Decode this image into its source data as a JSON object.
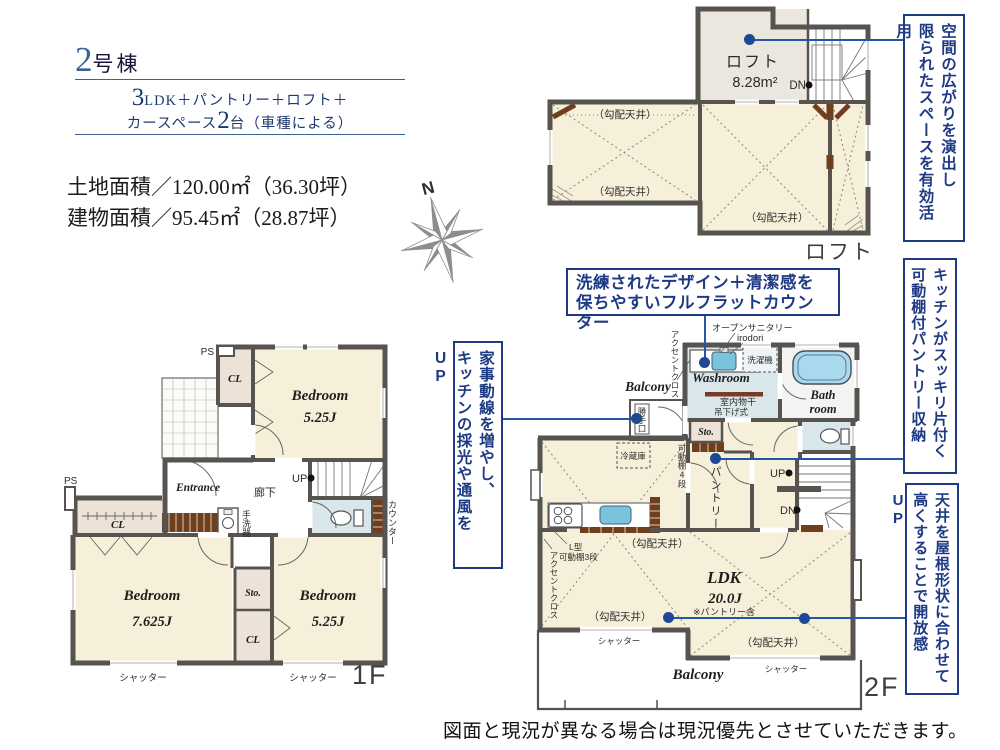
{
  "header": {
    "unit_num": "2",
    "unit_suffix": "号棟",
    "sub1_num": "3",
    "sub1_text": "LDK＋パントリー＋ロフト＋",
    "sub2_pre": "カースペース",
    "sub2_num": "2",
    "sub2_post": "台（車種による）"
  },
  "areas": {
    "land": "土地面積／120.00㎡（36.30坪）",
    "building": "建物面積／95.45㎡（28.87坪）"
  },
  "compass": {
    "north": "N"
  },
  "annotations": {
    "loft_space": {
      "line1": "空間の広がりを演出し",
      "line2": "限られたスペースを有効活用"
    },
    "pantry": {
      "line1": "キッチンがスッキリ片付く",
      "line2": "可動棚付パントリー収納"
    },
    "ceiling": {
      "line1": "天井を屋根形状に合わせて",
      "line2": "高くすることで開放感UP"
    },
    "housework": {
      "line1": "家事動線を増やし、",
      "line2": "キッチンの採光や通風をUP"
    },
    "counter": {
      "line1": "洗練されたデザイン＋清潔感を",
      "line2": "保ちやすいフルフラットカウンター"
    }
  },
  "loft": {
    "room": "ロフト",
    "area": "8.28m²",
    "dn": "DN",
    "sloped": "（勾配天井）",
    "floor_label": "ロフト"
  },
  "f1": {
    "ps": "PS",
    "cl": "CL",
    "bedroom": "Bedroom",
    "b1_size": "5.25J",
    "b2_size": "7.625J",
    "b3_size": "5.25J",
    "entrance": "Entrance",
    "corridor": "廊下",
    "up": "UP",
    "basin": "手洗器",
    "counter": "カウンター",
    "sto": "Sto.",
    "shutter": "シャッター",
    "floor_label": "1F"
  },
  "f2": {
    "accent": "アクセントクロス",
    "open_sanitary": "オープンサニタリー",
    "irodori": "irodori",
    "washer": "洗濯機",
    "washroom": "Washroom",
    "drying1": "室内物干",
    "drying2": "吊下げ式",
    "bath1": "Bath",
    "bath2": "room",
    "balcony": "Balcony",
    "door": "勝手口",
    "sto": "Sto.",
    "fridge": "冷蔵庫",
    "shelf4": "可動棚4段",
    "pantry": "パントリー",
    "up": "UP",
    "dn": "DN",
    "lshelf1": "L型",
    "lshelf2": "可動棚3段",
    "sloped": "（勾配天井）",
    "ldk": "LDK",
    "ldk_size": "20.0J",
    "ldk_note": "※パントリー含",
    "shutter": "シャッター",
    "floor_label": "2F"
  },
  "disclaimer": "図面と現況が異なる場合は現況優先とさせていただきます。",
  "colors": {
    "navy": "#1e3a85",
    "line_blue": "#2356a5",
    "wall": "#57534f",
    "cream": "#f6efd9",
    "wet": "#d9e6ea",
    "fixture": "#7ec3dd",
    "wood": "#6f3f1d"
  }
}
